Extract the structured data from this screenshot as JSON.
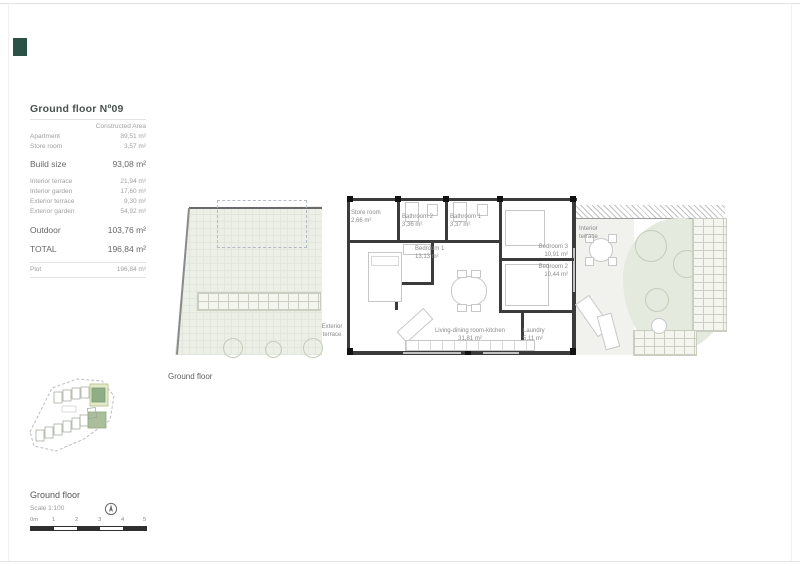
{
  "brand": {
    "logo_color": "#2b5247"
  },
  "area_table": {
    "title": "Ground floor Nº09",
    "column_header": "Constructed Area",
    "rows": [
      {
        "label": "Apartment",
        "value": "89,51 m²"
      },
      {
        "label": "Store room",
        "value": "3,57 m²"
      },
      {
        "label": "Build size",
        "value": "93,08 m²"
      },
      {
        "label": "Interior terrace",
        "value": "21,94 m²"
      },
      {
        "label": "Interior garden",
        "value": "17,60 m²"
      },
      {
        "label": "Exterior terrace",
        "value": "9,30 m²"
      },
      {
        "label": "Exterior garden",
        "value": "54,92 m²"
      },
      {
        "label": "Outdoor",
        "value": "103,76 m²"
      },
      {
        "label": "TOTAL",
        "value": "196,84 m²"
      },
      {
        "label": "Plot",
        "value": "196,84 m²"
      }
    ]
  },
  "floor_plan": {
    "caption": "Ground floor",
    "rooms": [
      {
        "name": "Store room",
        "area": "2,66 m²"
      },
      {
        "name": "Bathroom 2",
        "area": "3,36 m²"
      },
      {
        "name": "Bathroom 1",
        "area": "3,37 m²"
      },
      {
        "name": "Bedroom 1",
        "area": "13,13 m²"
      },
      {
        "name": "Bedroom 3",
        "area": "10,91 m²"
      },
      {
        "name": "Bedroom 2",
        "area": "10,44 m²"
      },
      {
        "name": "Living-dining room-kitchen",
        "area": "31,81 m²"
      },
      {
        "name": "Laundry",
        "area": "5,11 m²"
      },
      {
        "name": "Interior terrace",
        "area": ""
      },
      {
        "name": "Exterior terrace",
        "area": ""
      }
    ]
  },
  "footer": {
    "plan_title": "Ground floor",
    "scale_label": "Scale 1:100",
    "scale_ticks": [
      "0m",
      "1",
      "2",
      "3",
      "4",
      "5"
    ]
  },
  "colors": {
    "wall": "#3b3b3b",
    "garden_fill": "#ecefe6",
    "garden_blob": "#e4eade",
    "minimap_green": "#a9bf9b",
    "minimap_highlight": "#e3e9c9"
  }
}
